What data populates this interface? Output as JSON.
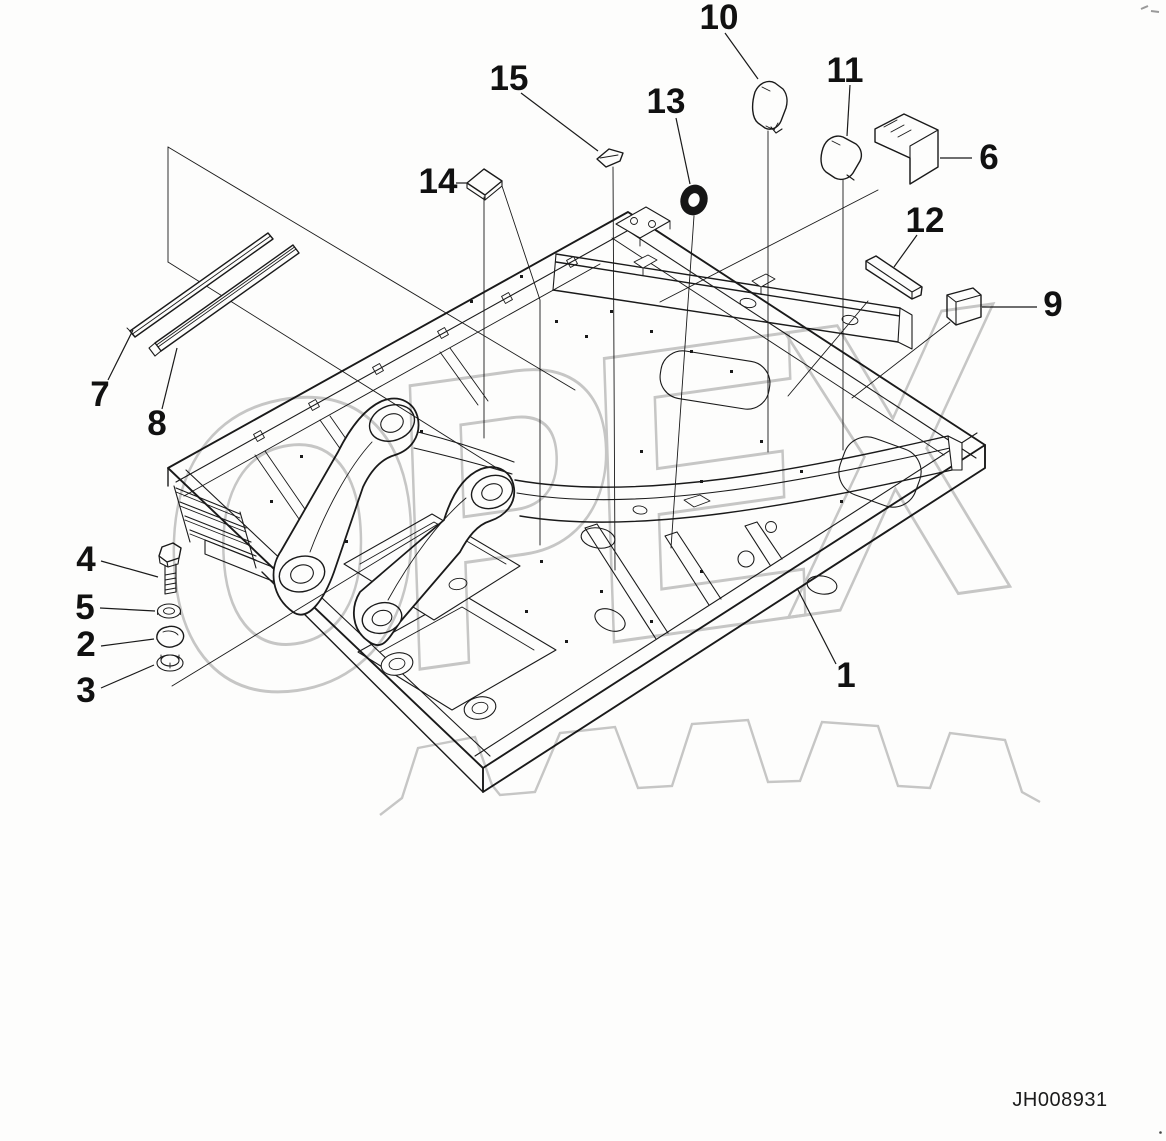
{
  "figure": {
    "code": "JH008931",
    "watermark_text": "OPEX",
    "callout_count": 15
  },
  "colors": {
    "background": "#fdfdfc",
    "line": "#1a1a1a",
    "watermark": "#c8c8c8"
  },
  "callouts": [
    {
      "num": "1",
      "label_x": 846,
      "label_y": 687,
      "x1": 836,
      "y1": 664,
      "x2": 797,
      "y2": 588
    },
    {
      "num": "2",
      "label_x": 86,
      "label_y": 656,
      "x1": 101,
      "y1": 646,
      "x2": 154,
      "y2": 639
    },
    {
      "num": "3",
      "label_x": 86,
      "label_y": 702,
      "x1": 101,
      "y1": 688,
      "x2": 154,
      "y2": 665
    },
    {
      "num": "4",
      "label_x": 86,
      "label_y": 571,
      "x1": 101,
      "y1": 561,
      "x2": 158,
      "y2": 577
    },
    {
      "num": "5",
      "label_x": 85,
      "label_y": 619,
      "x1": 100,
      "y1": 608,
      "x2": 155,
      "y2": 611
    },
    {
      "num": "6",
      "label_x": 989,
      "label_y": 169,
      "x1": 972,
      "y1": 158,
      "x2": 940,
      "y2": 158
    },
    {
      "num": "7",
      "label_x": 100,
      "label_y": 406,
      "x1": 108,
      "y1": 380,
      "x2": 133,
      "y2": 330
    },
    {
      "num": "8",
      "label_x": 157,
      "label_y": 435,
      "x1": 162,
      "y1": 409,
      "x2": 177,
      "y2": 348
    },
    {
      "num": "9",
      "label_x": 1053,
      "label_y": 316,
      "x1": 1037,
      "y1": 307,
      "x2": 982,
      "y2": 307
    },
    {
      "num": "10",
      "label_x": 719,
      "label_y": 29,
      "x1": 725,
      "y1": 33,
      "x2": 758,
      "y2": 79
    },
    {
      "num": "11",
      "label_x": 845,
      "label_y": 82,
      "x1": 850,
      "y1": 85,
      "x2": 847,
      "y2": 136
    },
    {
      "num": "12",
      "label_x": 925,
      "label_y": 232,
      "x1": 917,
      "y1": 235,
      "x2": 894,
      "y2": 267
    },
    {
      "num": "13",
      "label_x": 666,
      "label_y": 113,
      "x1": 676,
      "y1": 118,
      "x2": 690,
      "y2": 184
    },
    {
      "num": "14",
      "label_x": 438,
      "label_y": 193,
      "x1": 456,
      "y1": 183,
      "x2": 467,
      "y2": 183
    },
    {
      "num": "15",
      "label_x": 509,
      "label_y": 90,
      "x1": 521,
      "y1": 93,
      "x2": 598,
      "y2": 151
    }
  ]
}
